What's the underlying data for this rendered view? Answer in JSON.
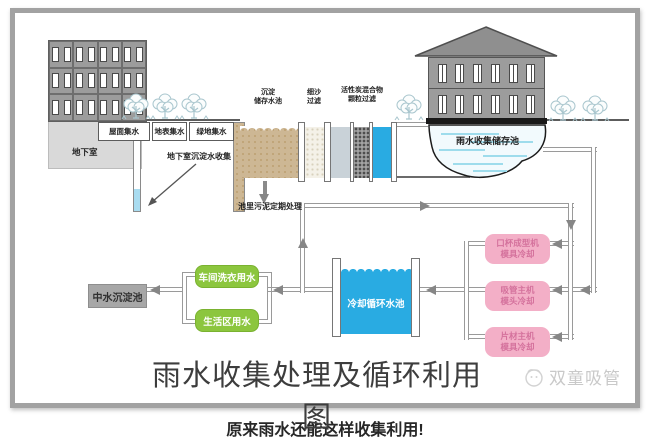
{
  "title": "雨水收集处理及循环利用图",
  "caption": "原来雨水还能这样收集利用!",
  "watermark": "双童吸管",
  "collection": {
    "basement": "地下室",
    "roof": "屋面集水",
    "surface": "地表集水",
    "green": "绿地集水",
    "note": "地下室沉淀水收集"
  },
  "treatment": {
    "sediment": {
      "line1": "沉淀",
      "line2": "储存水池"
    },
    "sand": {
      "line1": "细沙",
      "line2": "过滤"
    },
    "carbon": {
      "line1": "活性炭混合物",
      "line2": "颗粒过滤"
    },
    "sludge_note": "池里污泥定期处理"
  },
  "storage": {
    "pond": "雨水收集储存池"
  },
  "reuse": {
    "reclaim_pool": "中水沉淀池",
    "uses": [
      {
        "label": "车间洗衣用水"
      },
      {
        "label": "生活区用水"
      }
    ],
    "cooling_pool": "冷却循环水池",
    "machines": [
      {
        "line1": "口杯成型机",
        "line2": "模具冷却"
      },
      {
        "line1": "吸管主机",
        "line2": "模头冷却"
      },
      {
        "line1": "片材主机",
        "line2": "模具冷却"
      }
    ]
  },
  "colors": {
    "water_blue": "#29abe2",
    "pond_stripe": "#9edcec",
    "use_green": "#8cc63e",
    "machine_pink": "#f3afc7",
    "tank_tan": "#cdb794",
    "structure_gray": "#9c9c9c"
  }
}
